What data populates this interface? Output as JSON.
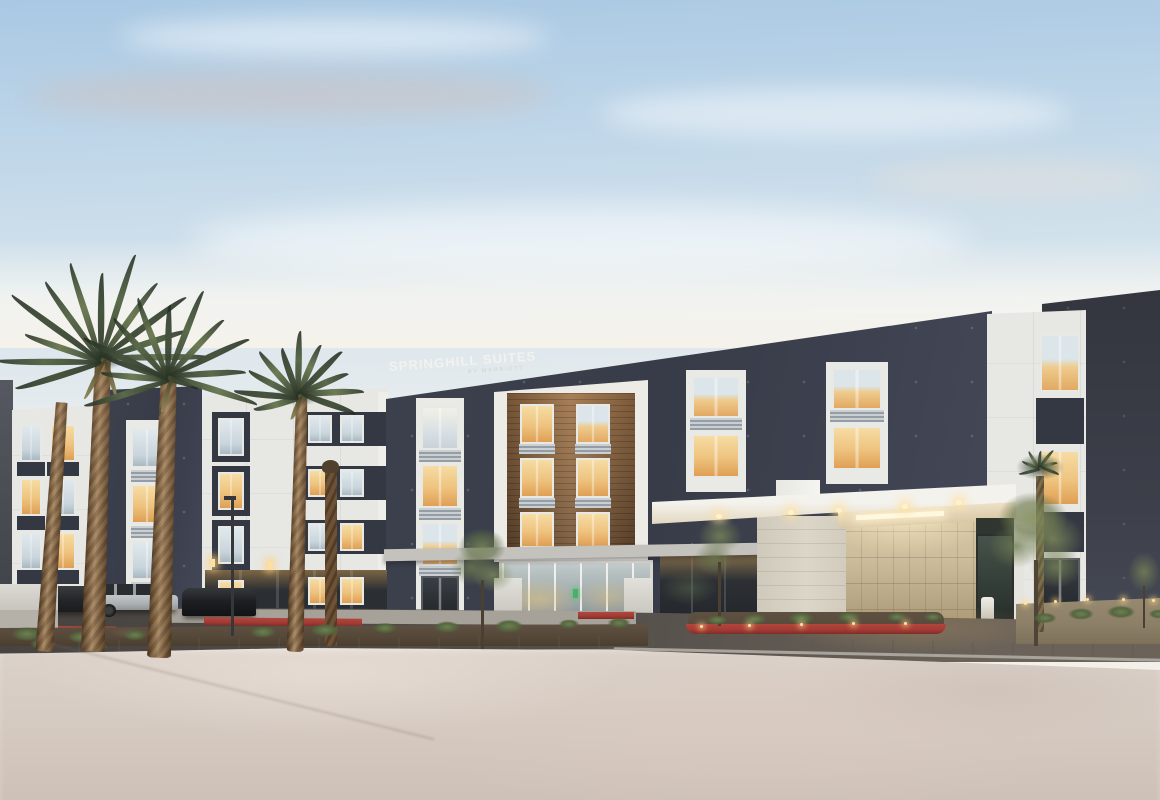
{
  "scene": {
    "type": "photograph",
    "subject": "SpringHill Suites by Marriott hotel exterior",
    "time_of_day": "dusk",
    "description": "Four-story modern hotel with dark navy and white facade sections, a wood-clad recessed center bay, warmly lit guest-room windows, a white porte-cochere entrance canopy with beige stone accent wall, desert landscaping with palm trees, red-painted curbs and an empty concrete forecourt."
  },
  "signage": {
    "brand_line1": "SPRINGHILL SUITES",
    "brand_line2": "BY MARRIOTT"
  },
  "palette": {
    "sky_top": "#a9c8e3",
    "sky_horizon": "#f3f0ea",
    "facade_dark": "#383c48",
    "facade_white": "#e7e7e4",
    "wood_panel": "#8a6542",
    "window_warm": "#eec37e",
    "window_cool": "#c9d5dc",
    "canopy_white": "#f4f2ed",
    "stone_wall": "#cdbd9c",
    "pillar": "#dcd6c9",
    "asphalt": "#534e49",
    "concrete_forecourt": "#d6cbc2",
    "red_curb": "#a23a33",
    "palm_frond": "#5a6a4b",
    "palm_trunk": "#8a6a45",
    "tree_foliage": "#7d8c5f",
    "dirt": "#564838"
  }
}
